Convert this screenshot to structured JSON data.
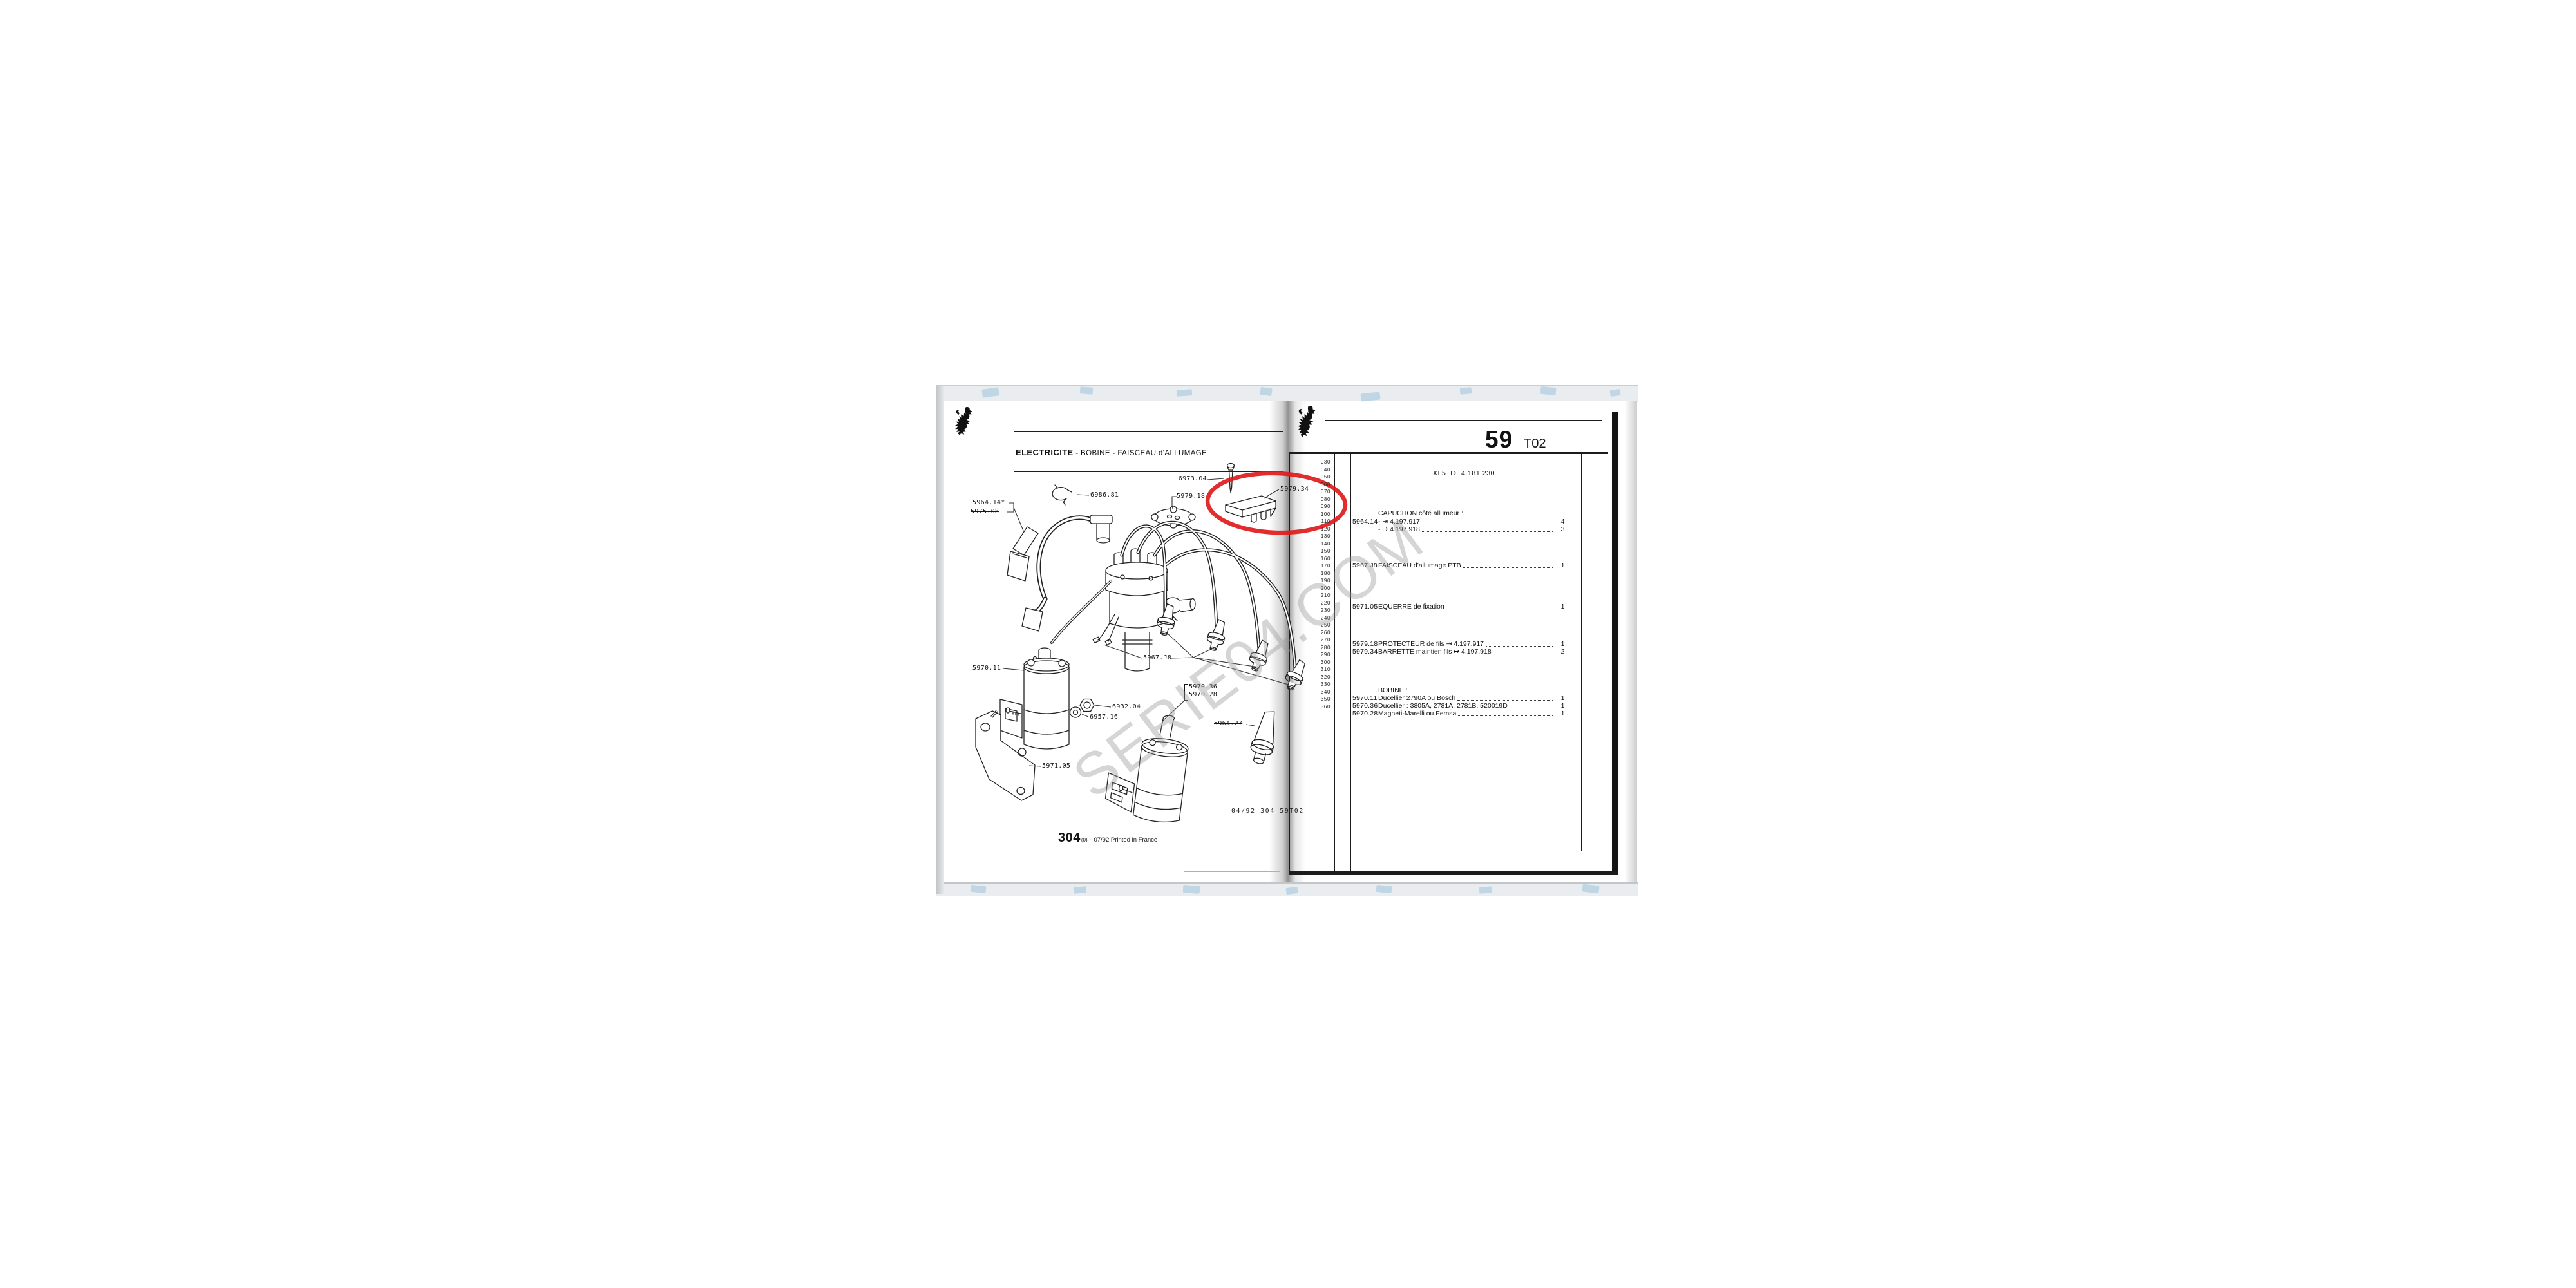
{
  "scan": {
    "watermark_text": "SERIE04.COM",
    "red_circle_color": "#de1b1b",
    "left_page": {
      "title_bold": "ELECTRICITE",
      "title_rest": " - BOBINE - FAISCEAU d'ALLUMAGE",
      "diagram_labels": {
        "p6973_04": "6973.04",
        "p5979_34": "5979.34",
        "p5979_18": "5979.18",
        "p6986_81": "6986.81",
        "p5964_14": "5964.14*",
        "p5975_08": "5975.08",
        "p5967_J8": "5967.J8",
        "p5970_36": "5970.36",
        "p5970_28": "5970.28",
        "p6932_04": "6932.04",
        "p6957_16": "6957.16",
        "p5970_11": "5970.11",
        "p5964_27": "5964.27",
        "p5971_05": "5971.05"
      },
      "plate_code": "04/92 304 59T02",
      "footer_num": "304",
      "footer_sub": "(0)",
      "footer_note": "- 07/92 Printed in France"
    },
    "right_page": {
      "page_number": "59",
      "page_code": "T02",
      "applicability_model": "XL5",
      "applicability_arrow": "↦",
      "applicability_ref": "4.181.230",
      "margin_numbers": [
        "030",
        "040",
        "050",
        "060",
        "070",
        "080",
        "090",
        "100",
        "110",
        "120",
        "130",
        "140",
        "150",
        "160",
        "170",
        "180",
        "190",
        "200",
        "210",
        "220",
        "230",
        "240",
        "250",
        "260",
        "270",
        "280",
        "290",
        "300",
        "310",
        "320",
        "330",
        "340",
        "350",
        "360"
      ],
      "rows": [
        {
          "type": "header",
          "text": "CAPUCHON côté allumeur :"
        },
        {
          "type": "part",
          "ref": "5964.14",
          "desc": "-  ⇥  4.197.917",
          "qty": "4"
        },
        {
          "type": "part",
          "ref": "",
          "desc": "-  ↦  4.197.918",
          "qty": "3"
        },
        {
          "type": "part",
          "ref": "5967.J8",
          "desc": "FAISCEAU d'allumage PTB",
          "qty": "1"
        },
        {
          "type": "part",
          "ref": "5971.05",
          "desc": "EQUERRE de fixation",
          "qty": "1"
        },
        {
          "type": "part",
          "ref": "5979.18",
          "desc": "PROTECTEUR de fils  ⇥  4.197.917",
          "qty": "1"
        },
        {
          "type": "part",
          "ref": "5979.34",
          "desc": "BARRETTE maintien fils  ↦  4.197.918",
          "qty": "2"
        },
        {
          "type": "header",
          "text": "BOBINE :"
        },
        {
          "type": "part",
          "ref": "5970.11",
          "desc": "Ducellier 2790A ou Bosch",
          "qty": "1"
        },
        {
          "type": "part",
          "ref": "5970.36",
          "desc": "Ducellier : 3805A, 2781A, 2781B, 520019D",
          "qty": "1"
        },
        {
          "type": "part",
          "ref": "5970.28",
          "desc": "Magneti-Marelli ou Femsa",
          "qty": "1"
        }
      ]
    }
  }
}
